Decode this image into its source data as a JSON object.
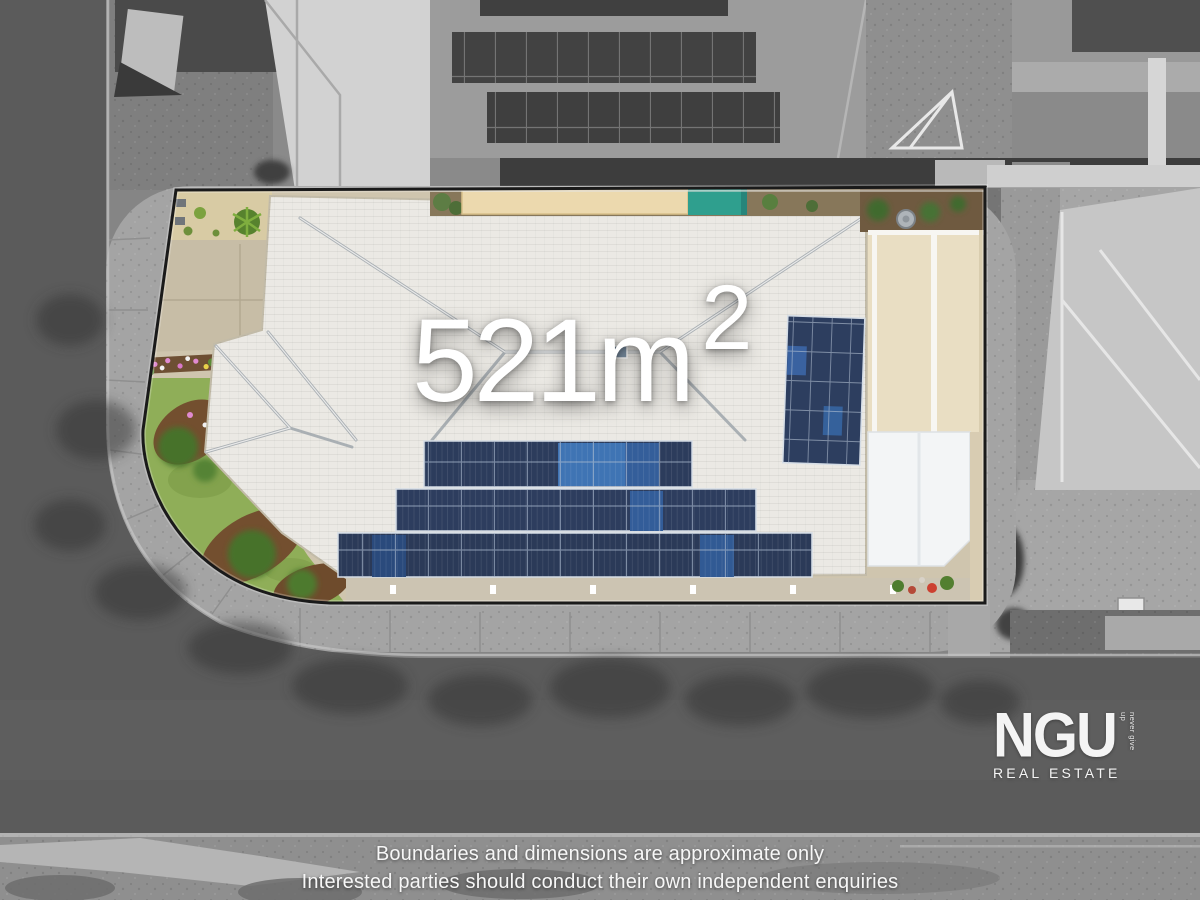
{
  "overlay": {
    "area_text": "521m",
    "area_superscript": "2"
  },
  "logo": {
    "brand": "NGU",
    "tagline_vertical": "never give up",
    "subtitle": "REAL ESTATE"
  },
  "disclaimer": {
    "line1": "Boundaries and dimensions are approximate only",
    "line2": "Interested parties should conduct their own independent enquiries"
  },
  "scene": {
    "boundary_shape": "corner lot, rounded bottom-left corner",
    "features": [
      "white-tiled hip roof",
      "three rows of solar panels on lower roof",
      "portrait solar array on right roof face",
      "green lawn and mulch gardens bottom-left",
      "tan driveway top-left",
      "teal cover and cream mat along top edge",
      "beige patio roof and white awning on right",
      "greyscale surrounding streets"
    ]
  },
  "colors": {
    "boundary_line": "#1a1a1a",
    "roof_tiles_white": "#ebe9e4",
    "solar_panel_navy": "#2d3e5f",
    "solar_panel_bright": "#3e6ca8",
    "lawn_green": "#8fae58",
    "mulch_brown": "#734f2f",
    "teal_pool_cover": "#2f9f8e",
    "patio_beige": "#e9dec3",
    "driveway_tan": "#c7bda6",
    "road_grey": "#5b5b5b",
    "text_white": "#ffffff"
  }
}
